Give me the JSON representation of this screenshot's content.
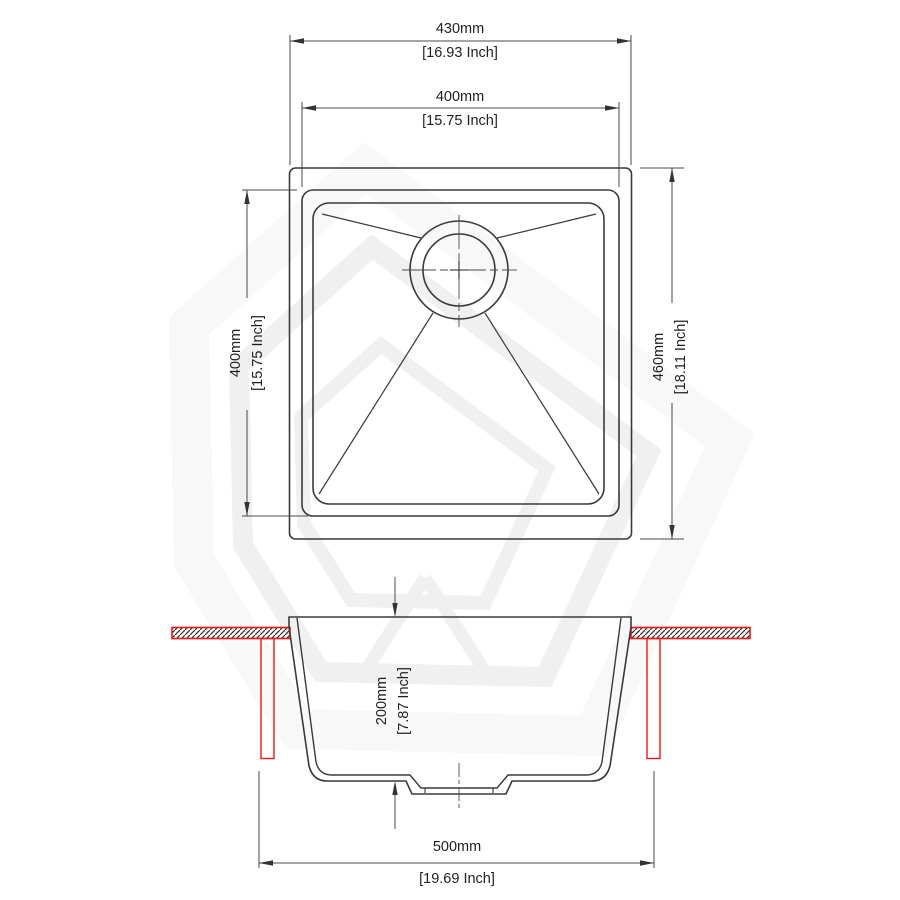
{
  "drawing": {
    "title": "kitchen-sink-technical-drawing",
    "colors": {
      "line": "#3a3a3a",
      "dim_line": "#4a4a4a",
      "red": "#f21515",
      "watermark": "#f0f0f0",
      "watermark_faint": "#f8f8f8",
      "background": "#ffffff"
    },
    "dims": {
      "overall_width": {
        "mm": "430mm",
        "inch": "[16.93 Inch]"
      },
      "bowl_width": {
        "mm": "400mm",
        "inch": "[15.75 Inch]"
      },
      "bowl_length": {
        "mm": "400mm",
        "inch": "[15.75 Inch]"
      },
      "overall_length": {
        "mm": "460mm",
        "inch": "[18.11 Inch]"
      },
      "bowl_depth": {
        "mm": "200mm",
        "inch": "[7.87 Inch]"
      },
      "cutout_width": {
        "mm": "500mm",
        "inch": "[19.69 Inch]"
      }
    }
  }
}
